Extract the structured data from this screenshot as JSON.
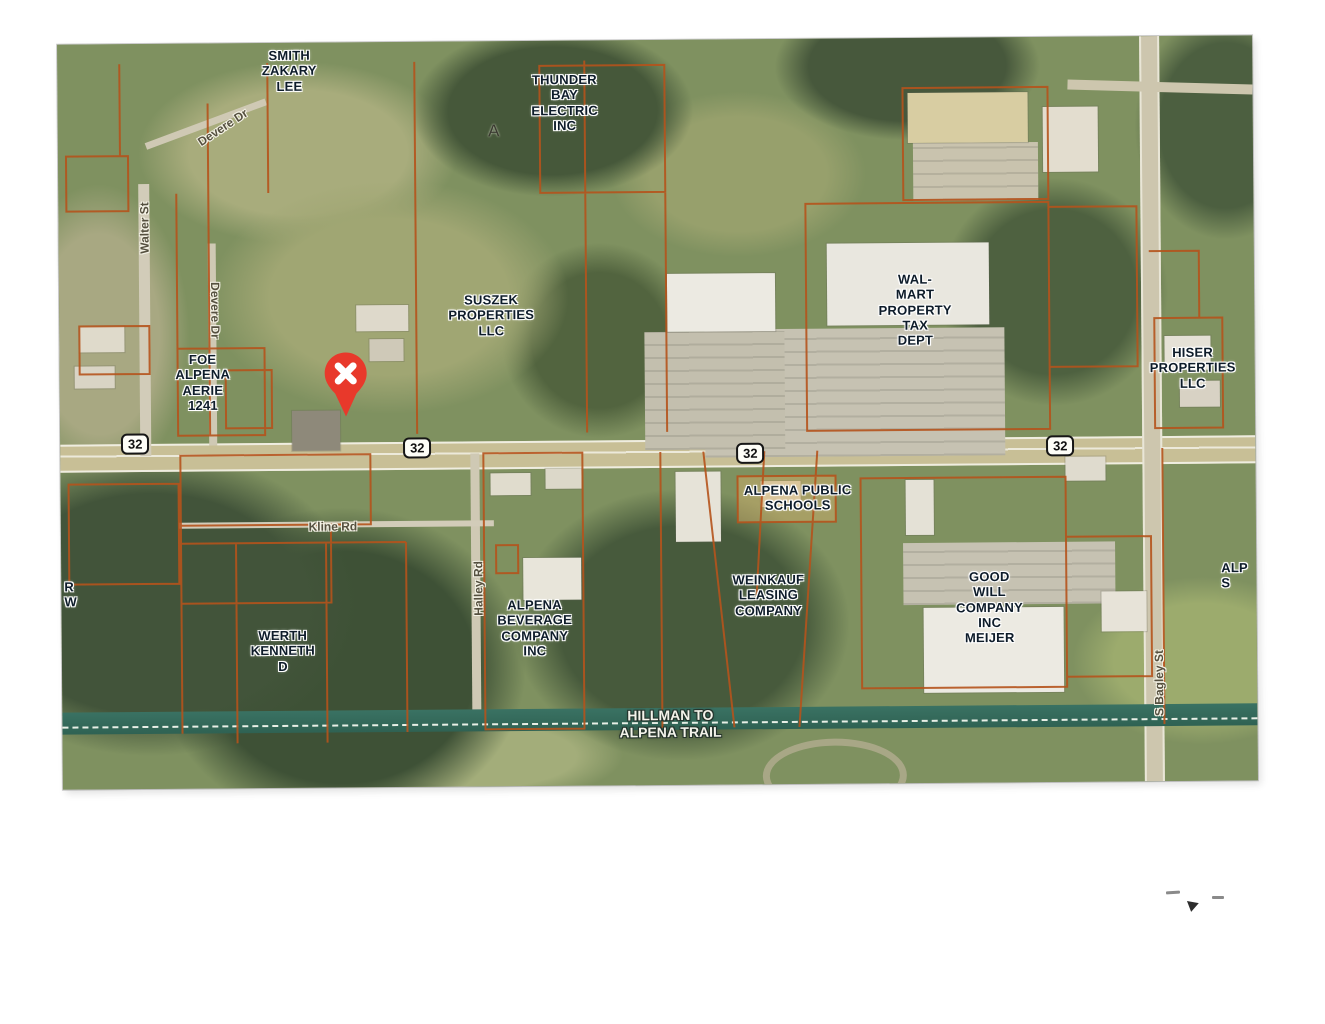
{
  "map": {
    "colors": {
      "parcel_line": "#b5531c",
      "marker_red": "#e8392b",
      "trail_teal": "#33705f",
      "label_ink": "#0e1c2a",
      "road_label_ink": "#55503f",
      "shield_bg": "#fdfdf7"
    },
    "parcel_labels": [
      {
        "name": "label-smith-zakary-lee",
        "text": "SMITH\nZAKARY\nLEE",
        "x": 232,
        "y": 28
      },
      {
        "name": "label-thunder-bay-electric",
        "text": "THUNDER\nBAY\nELECTRIC\nINC",
        "x": 507,
        "y": 62
      },
      {
        "name": "label-suszek-properties",
        "text": "SUSZEK\nPROPERTIES\nLLC",
        "x": 432,
        "y": 274
      },
      {
        "name": "label-foe-alpena-aerie",
        "text": "FOE\nALPENA\nAERIE\n1241",
        "x": 143,
        "y": 339
      },
      {
        "name": "label-walmart-property-tax",
        "text": "WAL-\nMART\nPROPERTY\nTAX\nDEPT",
        "x": 856,
        "y": 272
      },
      {
        "name": "label-hiser-properties",
        "text": "HISER\nPROPERTIES\nLLC",
        "x": 1133,
        "y": 332
      },
      {
        "name": "label-alpena-public-schools",
        "text": "ALPENA PUBLIC\nSCHOOLS",
        "x": 737,
        "y": 459
      },
      {
        "name": "label-alpena-beverage",
        "text": "ALPENA\nBEVERAGE\nCOMPANY\nINC",
        "x": 473,
        "y": 587
      },
      {
        "name": "label-weinkauf-leasing",
        "text": "WEINKAUF\nLEASING\nCOMPANY",
        "x": 707,
        "y": 556
      },
      {
        "name": "label-goodwill-meijer",
        "text": "GOOD\nWILL\nCOMPANY\nINC\nMEIJER",
        "x": 928,
        "y": 570
      },
      {
        "name": "label-werth-kenneth",
        "text": "WERTH\nKENNETH\nD",
        "x": 221,
        "y": 608
      },
      {
        "name": "label-edge-partial-left",
        "text": "R\nW",
        "x": 3,
        "y": 550,
        "align": "left"
      },
      {
        "name": "label-edge-partial-right",
        "text": "ALP\nS",
        "x": 1160,
        "y": 540,
        "align": "left"
      }
    ],
    "road_labels": [
      {
        "name": "road-label-devere-dr-diagonal",
        "text": "Devere Dr",
        "x": 165,
        "y": 84,
        "rot": -33
      },
      {
        "name": "road-label-walter-st",
        "text": "Walter St",
        "x": 86,
        "y": 184,
        "rot": -90
      },
      {
        "name": "road-label-devere-dr-vertical",
        "text": "Devere Dr",
        "x": 156,
        "y": 267,
        "rot": 90
      },
      {
        "name": "road-label-kline-rd",
        "text": "Kline Rd",
        "x": 272,
        "y": 484,
        "rot": 0
      },
      {
        "name": "road-label-halley-rd",
        "text": "Halley Rd",
        "x": 417,
        "y": 547,
        "rot": -90
      },
      {
        "name": "road-label-s-bagley-st",
        "text": "S Bagley St",
        "x": 1097,
        "y": 647,
        "rot": -90
      }
    ],
    "route_shields": [
      {
        "name": "route-shield-32-west",
        "label": "32",
        "x": 75,
        "y": 400
      },
      {
        "name": "route-shield-32-midwest",
        "label": "32",
        "x": 357,
        "y": 406
      },
      {
        "name": "route-shield-32-mideast",
        "label": "32",
        "x": 690,
        "y": 414
      },
      {
        "name": "route-shield-32-east",
        "label": "32",
        "x": 1000,
        "y": 409
      }
    ],
    "trail_label": {
      "text": "HILLMAN TO\nALPENA TRAIL"
    },
    "tower_symbol": "A",
    "marker": {
      "type": "red-x-pin",
      "x": 286,
      "y": 309
    }
  }
}
